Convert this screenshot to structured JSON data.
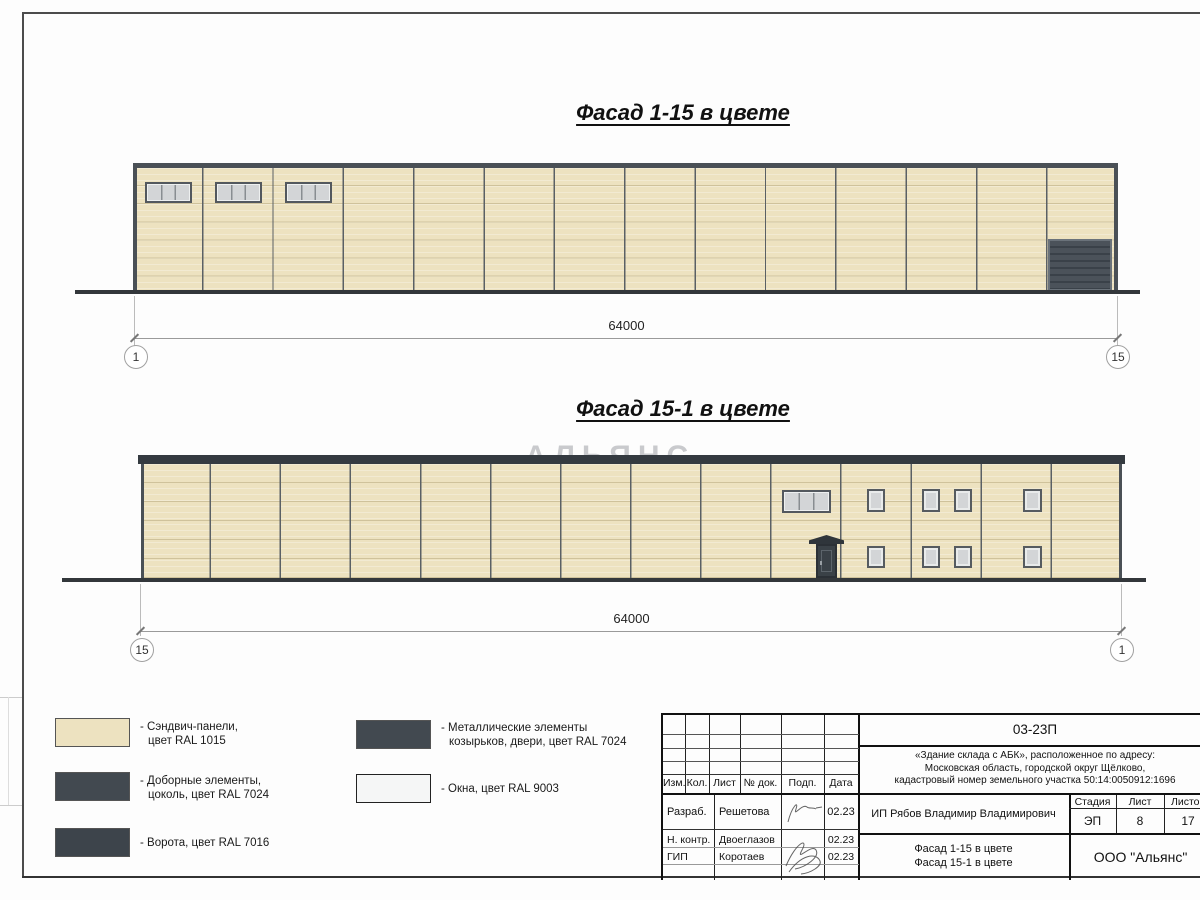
{
  "facade1": {
    "title": "Фасад 1-15 в цвете",
    "dimension": "64000",
    "axis_left": "1",
    "axis_right": "15"
  },
  "facade2": {
    "title": "Фасад 15-1 в цвете",
    "dimension": "64000",
    "axis_left": "15",
    "axis_right": "1"
  },
  "watermark": {
    "line1": "АЛЬЯНС",
    "line2": "строительная компания"
  },
  "colors": {
    "panel_ral1015": "#EDE2C0",
    "trim_ral7024": "#424950",
    "gate_ral7016": "#3D444B",
    "window_ral9003": "#F5F6F6"
  },
  "legend": {
    "items": [
      {
        "color": "#EDE2C0",
        "line1": "- Сэндвич-панели,",
        "line2": "цвет RAL 1015"
      },
      {
        "color": "#424950",
        "line1": "- Доборные элементы,",
        "line2": "цоколь, цвет RAL 7024"
      },
      {
        "color": "#3D444B",
        "line1": "- Ворота, цвет RAL 7016",
        "line2": ""
      },
      {
        "color": "#424950",
        "line1": "- Металлические элементы",
        "line2": "козырьков, двери, цвет RAL 7024"
      },
      {
        "color": "#F5F6F6",
        "line1": "- Окна, цвет RAL 9003",
        "line2": ""
      }
    ]
  },
  "titleblock": {
    "doc_number": "03-23П",
    "address_line1": "«Здание склада с АБК», расположенное по адресу:",
    "address_line2": "Московская область, городской округ Щёлково,",
    "address_line3": "кадастровый номер земельного участка 50:14:0050912:1696",
    "header": {
      "izm": "Изм.",
      "kol": "Кол.",
      "list": "Лист",
      "ndok": "№ док.",
      "podp": "Подп.",
      "data": "Дата"
    },
    "rows": [
      {
        "role": "Разраб.",
        "name": "Решетова",
        "date": "02.23"
      },
      {
        "role": "Н. контр.",
        "name": "Двоеглазов",
        "date": "02.23"
      },
      {
        "role": "ГИП",
        "name": "Коротаев",
        "date": "02.23"
      }
    ],
    "client": "ИП Рябов Владимир Владимирович",
    "stage_label": "Стадия",
    "sheet_label": "Лист",
    "sheets_label": "Листов",
    "stage": "ЭП",
    "sheet_num": "8",
    "sheets_total": "17",
    "drawing_name_line1": "Фасад 1-15 в цвете",
    "drawing_name_line2": "Фасад 15-1 в цвете",
    "organization": "ООО \"Альянс\""
  }
}
